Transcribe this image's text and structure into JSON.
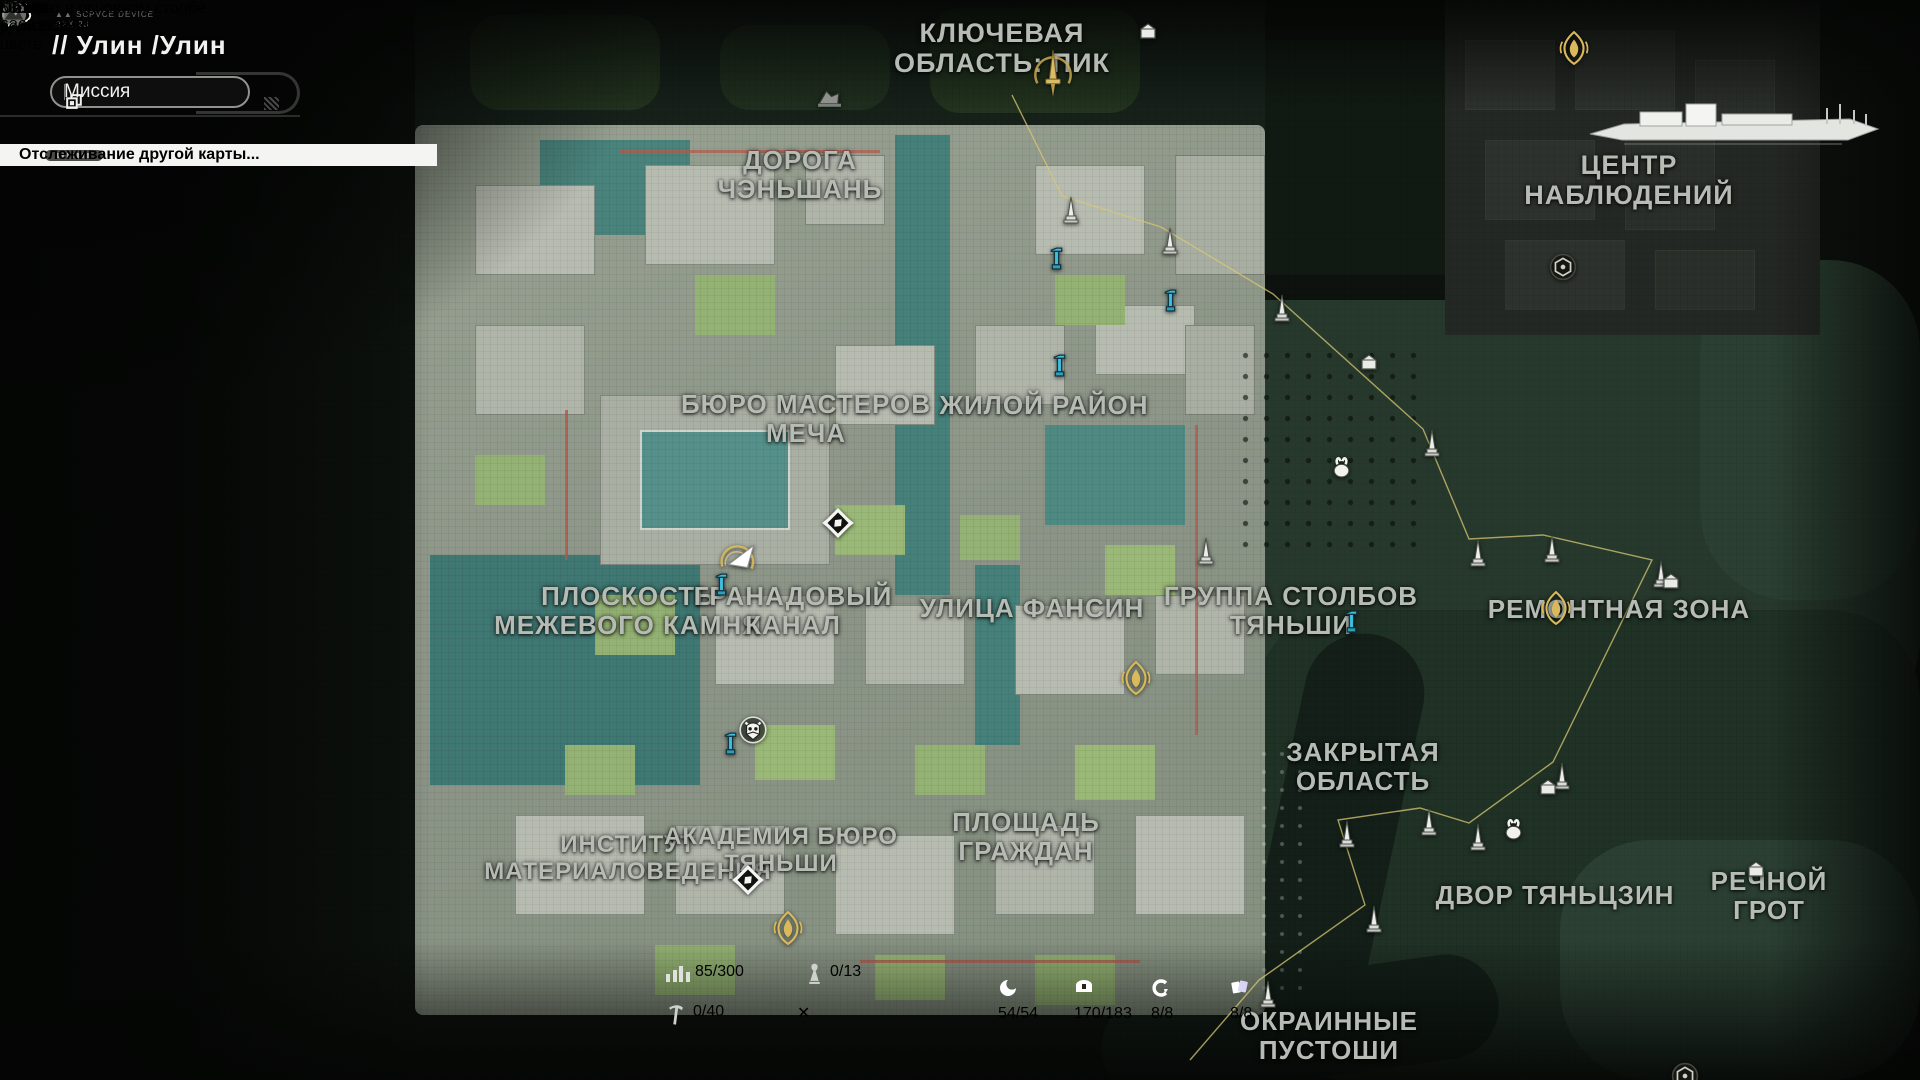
{
  "hud": {
    "device_label": "SCPVCE DEVICE\nRXX-23",
    "region_title": "// Улин  /Улин",
    "mission_button": "Миссия",
    "banner_text": "Отслеживание другой карты...",
    "toast_text": "Теперь в цвете",
    "waveplate_count": "43/348",
    "plus_label": "+",
    "ship_label": "ОМК «ДИЦЗЯН»",
    "tooltip_text": "Кабинет в основном столбе",
    "marks_button": "Метки",
    "ping": "63ms",
    "uid": "UID: 6366396984",
    "region_overview_button": "Обзор регионов",
    "zoom_plus": "+"
  },
  "stats": {
    "exploration": "85/300",
    "statues": "0/13",
    "nodes": "0/40"
  },
  "counters": [
    {
      "kind": "swirl",
      "value": "54/54",
      "color": "#e4792f",
      "x": 998
    },
    {
      "kind": "chest",
      "value": "170/183",
      "color": "#b9e03b",
      "x": 1074
    },
    {
      "kind": "cbolt",
      "value": "8/8",
      "color": "#3cd8c2",
      "x": 1151
    },
    {
      "kind": "cards",
      "value": "8/8",
      "color": "#8577e6",
      "x": 1230
    }
  ],
  "map": {
    "labels": [
      {
        "t": "КЛЮЧЕВАЯ\nОБЛАСТЬ: ПИК",
        "x": 1002,
        "y": 18,
        "s": 27
      },
      {
        "t": "ДОРОГА\nЧЭНЬШАНЬ",
        "x": 800,
        "y": 146,
        "s": 26
      },
      {
        "t": "ЦЕНТР\nНАБЛЮДЕНИЙ",
        "x": 1629,
        "y": 150,
        "s": 27
      },
      {
        "t": "БЮРО МАСТЕРОВ\nМЕЧА",
        "x": 806,
        "y": 390,
        "s": 26
      },
      {
        "t": "ЖИЛОЙ РАЙОН",
        "x": 1044,
        "y": 391,
        "s": 26
      },
      {
        "t": "ПЛОСКОСТЬ\nМЕЖЕВОГО КАМНЯ",
        "x": 628,
        "y": 582,
        "s": 26
      },
      {
        "t": "ГРАНАДОВЫЙ\nКАНАЛ",
        "x": 793,
        "y": 582,
        "s": 26
      },
      {
        "t": "УЛИЦА ФАНСИН",
        "x": 1032,
        "y": 594,
        "s": 26
      },
      {
        "t": "ГРУППА СТОЛБОВ\nТЯНЬШИ",
        "x": 1291,
        "y": 582,
        "s": 26
      },
      {
        "t": "РЕМОНТНАЯ ЗОНА",
        "x": 1619,
        "y": 595,
        "s": 26
      },
      {
        "t": "ЗАКРЫТАЯ\nОБЛАСТЬ",
        "x": 1363,
        "y": 738,
        "s": 26
      },
      {
        "t": "ИНСТИТУТ\nМАТЕРИАЛОВЕДЕНИЯ",
        "x": 628,
        "y": 832,
        "s": 24
      },
      {
        "t": "АКАДЕМИЯ БЮРО\nТЯНЬШИ",
        "x": 781,
        "y": 824,
        "s": 24
      },
      {
        "t": "ПЛОЩАДЬ\nГРАЖДАН",
        "x": 1026,
        "y": 808,
        "s": 26
      },
      {
        "t": "ДВОР ТЯНЬЦЗИН",
        "x": 1555,
        "y": 881,
        "s": 26
      },
      {
        "t": "РЕЧНОЙ ГРОТ",
        "x": 1769,
        "y": 867,
        "s": 26
      },
      {
        "t": "ОКРАИННЫЕ\nПУСТОШИ",
        "x": 1329,
        "y": 1007,
        "s": 26
      }
    ],
    "markers": [
      {
        "k": "sword",
        "x": 1030,
        "y": 48
      },
      {
        "k": "helmet",
        "x": 816,
        "y": 88
      },
      {
        "k": "house",
        "x": 1138,
        "y": 22
      },
      {
        "k": "obelisk",
        "x": 1062,
        "y": 196
      },
      {
        "k": "obelisk",
        "x": 1161,
        "y": 227
      },
      {
        "k": "obelisk",
        "x": 1273,
        "y": 294
      },
      {
        "k": "obelisk",
        "x": 1423,
        "y": 429
      },
      {
        "k": "obelisk",
        "x": 1469,
        "y": 539
      },
      {
        "k": "obelisk",
        "x": 1543,
        "y": 535
      },
      {
        "k": "obelisk",
        "x": 1652,
        "y": 560
      },
      {
        "k": "obelisk",
        "x": 1553,
        "y": 762
      },
      {
        "k": "obelisk",
        "x": 1469,
        "y": 823
      },
      {
        "k": "obelisk",
        "x": 1420,
        "y": 808
      },
      {
        "k": "obelisk",
        "x": 1338,
        "y": 820
      },
      {
        "k": "obelisk",
        "x": 1365,
        "y": 905
      },
      {
        "k": "obelisk",
        "x": 1259,
        "y": 980
      },
      {
        "k": "obelisk",
        "x": 1197,
        "y": 537
      },
      {
        "k": "pump",
        "x": 1049,
        "y": 245
      },
      {
        "k": "pump",
        "x": 1163,
        "y": 287
      },
      {
        "k": "pump",
        "x": 1052,
        "y": 352
      },
      {
        "k": "pump",
        "x": 714,
        "y": 571
      },
      {
        "k": "pump",
        "x": 1344,
        "y": 608
      },
      {
        "k": "pump",
        "x": 723,
        "y": 730
      },
      {
        "k": "bunny",
        "x": 1331,
        "y": 455
      },
      {
        "k": "bunny",
        "x": 1503,
        "y": 817
      },
      {
        "k": "house",
        "x": 1359,
        "y": 353
      },
      {
        "k": "house",
        "x": 1538,
        "y": 778
      },
      {
        "k": "house",
        "x": 1661,
        "y": 572
      },
      {
        "k": "house",
        "x": 1746,
        "y": 860
      },
      {
        "k": "demblem",
        "x": 1549,
        "y": 253
      },
      {
        "k": "demblem",
        "x": 1671,
        "y": 1062
      },
      {
        "k": "gemblem",
        "x": 1120,
        "y": 660
      },
      {
        "k": "gemblem",
        "x": 1540,
        "y": 590
      },
      {
        "k": "gemblem",
        "x": 772,
        "y": 910
      },
      {
        "k": "gemblem",
        "x": 1558,
        "y": 30
      },
      {
        "k": "fast",
        "x": 820,
        "y": 505
      },
      {
        "k": "fast",
        "x": 730,
        "y": 862
      },
      {
        "k": "owl",
        "x": 737,
        "y": 715
      },
      {
        "k": "player",
        "x": 716,
        "y": 533
      }
    ],
    "path_points": "1012,95 1062,196 1161,227 1273,294 1423,429 1469,539 1543,535 1652,560 1553,762 1469,823 1420,808 1338,820 1365,905 1259,980 1190,1060"
  }
}
